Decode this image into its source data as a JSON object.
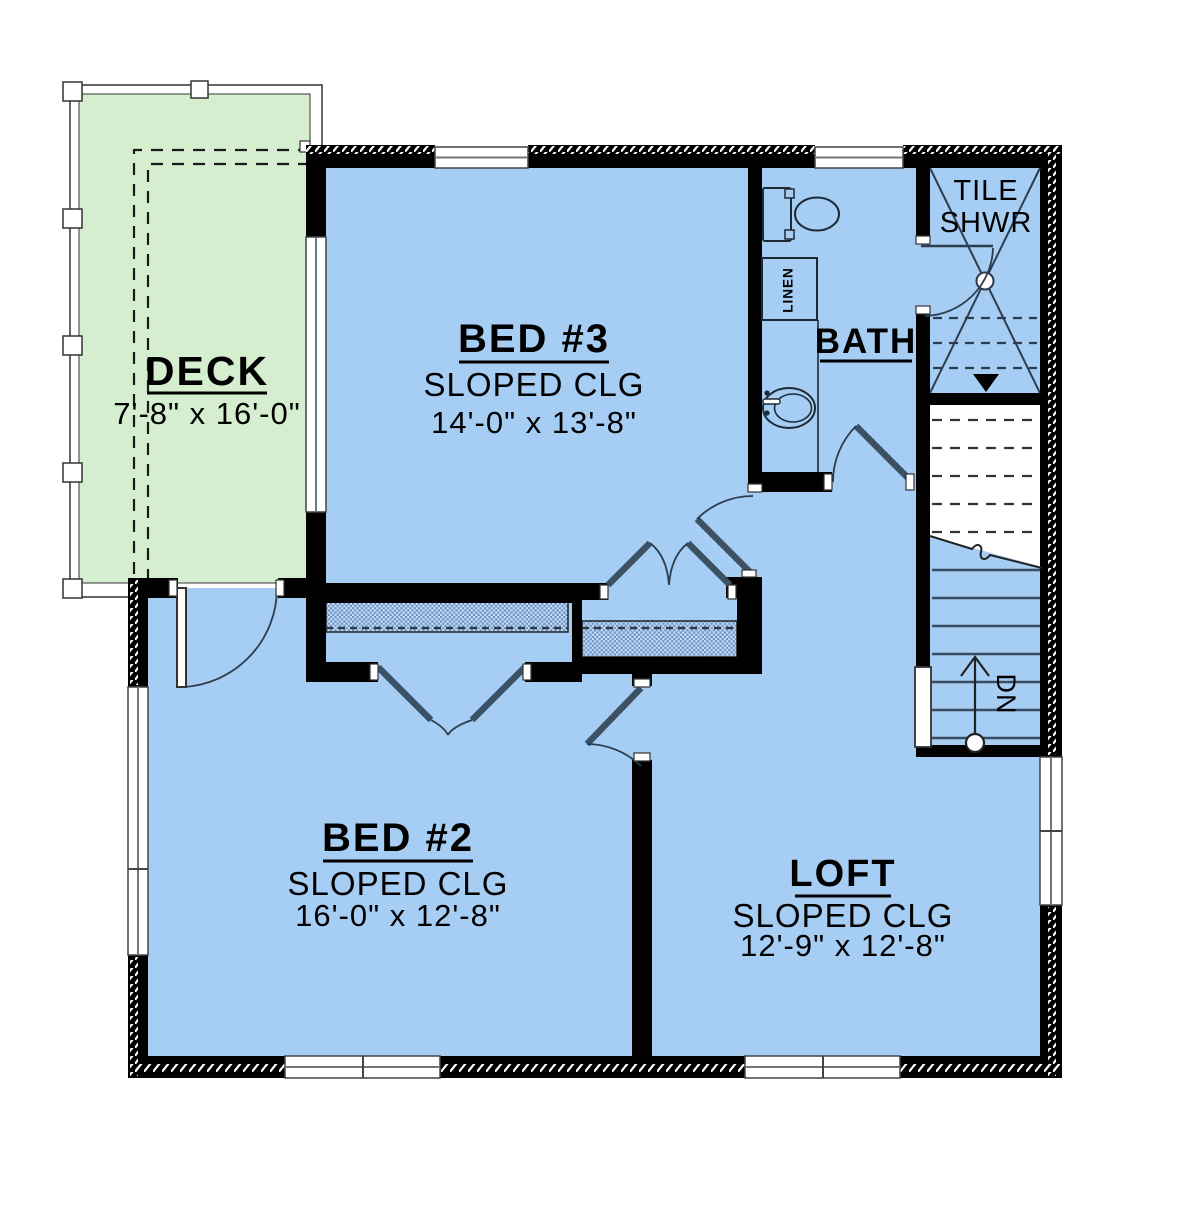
{
  "plan": {
    "rooms": {
      "deck": {
        "name": "DECK",
        "dims": "7'-8\" x 16'-0\""
      },
      "bed3": {
        "name": "BED #3",
        "ceiling": "SLOPED CLG",
        "dims": "14'-0\" x 13'-8\""
      },
      "bed2": {
        "name": "BED #2",
        "ceiling": "SLOPED CLG",
        "dims": "16'-0\" x 12'-8\""
      },
      "loft": {
        "name": "LOFT",
        "ceiling": "SLOPED CLG",
        "dims": "12'-9\" x 12'-8\""
      },
      "bath": {
        "name": "BATH"
      },
      "shower": {
        "line1": "TILE",
        "line2": "SHWR"
      },
      "linen": {
        "name": "LINEN"
      },
      "stairs": {
        "direction": "DN"
      }
    },
    "colors": {
      "room_fill": "#a6cdf3",
      "deck_fill": "#d6eed0",
      "wall": "#000000",
      "door_leaf": "#3d5166",
      "line_dark": "#2e3d4d",
      "window_line": "#6f767c",
      "closet_hatch": "#6b92c4",
      "text": "#000000"
    }
  }
}
